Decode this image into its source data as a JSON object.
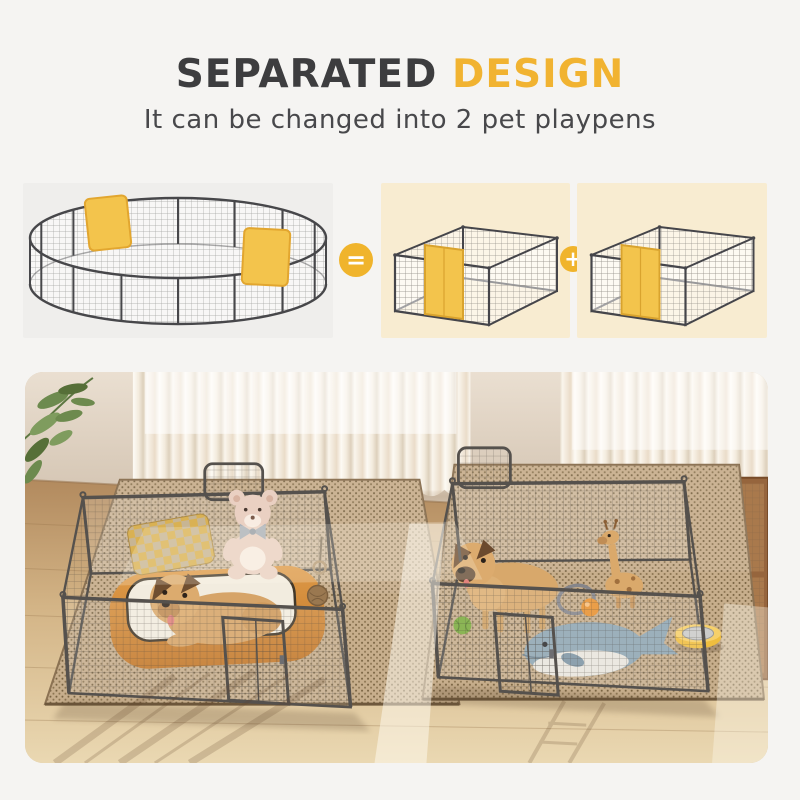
{
  "page": {
    "background_color": "#f5f4f2"
  },
  "header": {
    "title_primary": "SEPARATED",
    "title_accent": "DESIGN",
    "subtitle": "It can be changed into 2 pet playpens",
    "title_primary_color": "#3d3d3f",
    "title_accent_color": "#f1b331",
    "subtitle_color": "#48484b"
  },
  "equation": {
    "full_playpen_card": {
      "image": "sixteen-panel-round-playpen-with-two-yellow-gates",
      "background": "#efeeec"
    },
    "equals_icon": {
      "symbol": "=",
      "circle_color": "#f0b42c"
    },
    "split_playpen_card_a": {
      "image": "eight-panel-rectangular-playpen-with-yellow-gate",
      "background": "#f8ecd1"
    },
    "plus_icon": {
      "symbol": "+",
      "circle_color": "#f0b42c"
    },
    "split_playpen_card_b": {
      "image": "eight-panel-rectangular-playpen-with-yellow-gate",
      "background": "#f8ecd1"
    }
  },
  "photo": {
    "scene": "two-metal-pet-playpens-on-rugs-in-sunlit-room",
    "frame_color": "#55514d",
    "gate_highlight_color": "#f3c44c",
    "left_pen_items": [
      "french-bulldog-lying",
      "orange-dog-bed",
      "plaid-pillow",
      "teddy-bear-plush",
      "hanging-chew-toy"
    ],
    "right_pen_items": [
      "french-bulldog-standing",
      "whale-plush",
      "giraffe-plush",
      "green-ball",
      "ring-toy",
      "orange-ball",
      "yellow-pet-bowl"
    ],
    "background_items": [
      "potted-plant",
      "sheer-curtain-window-left",
      "sheer-curtain-window-right",
      "rattan-cabinet",
      "jute-rug-left",
      "jute-rug-right"
    ]
  }
}
